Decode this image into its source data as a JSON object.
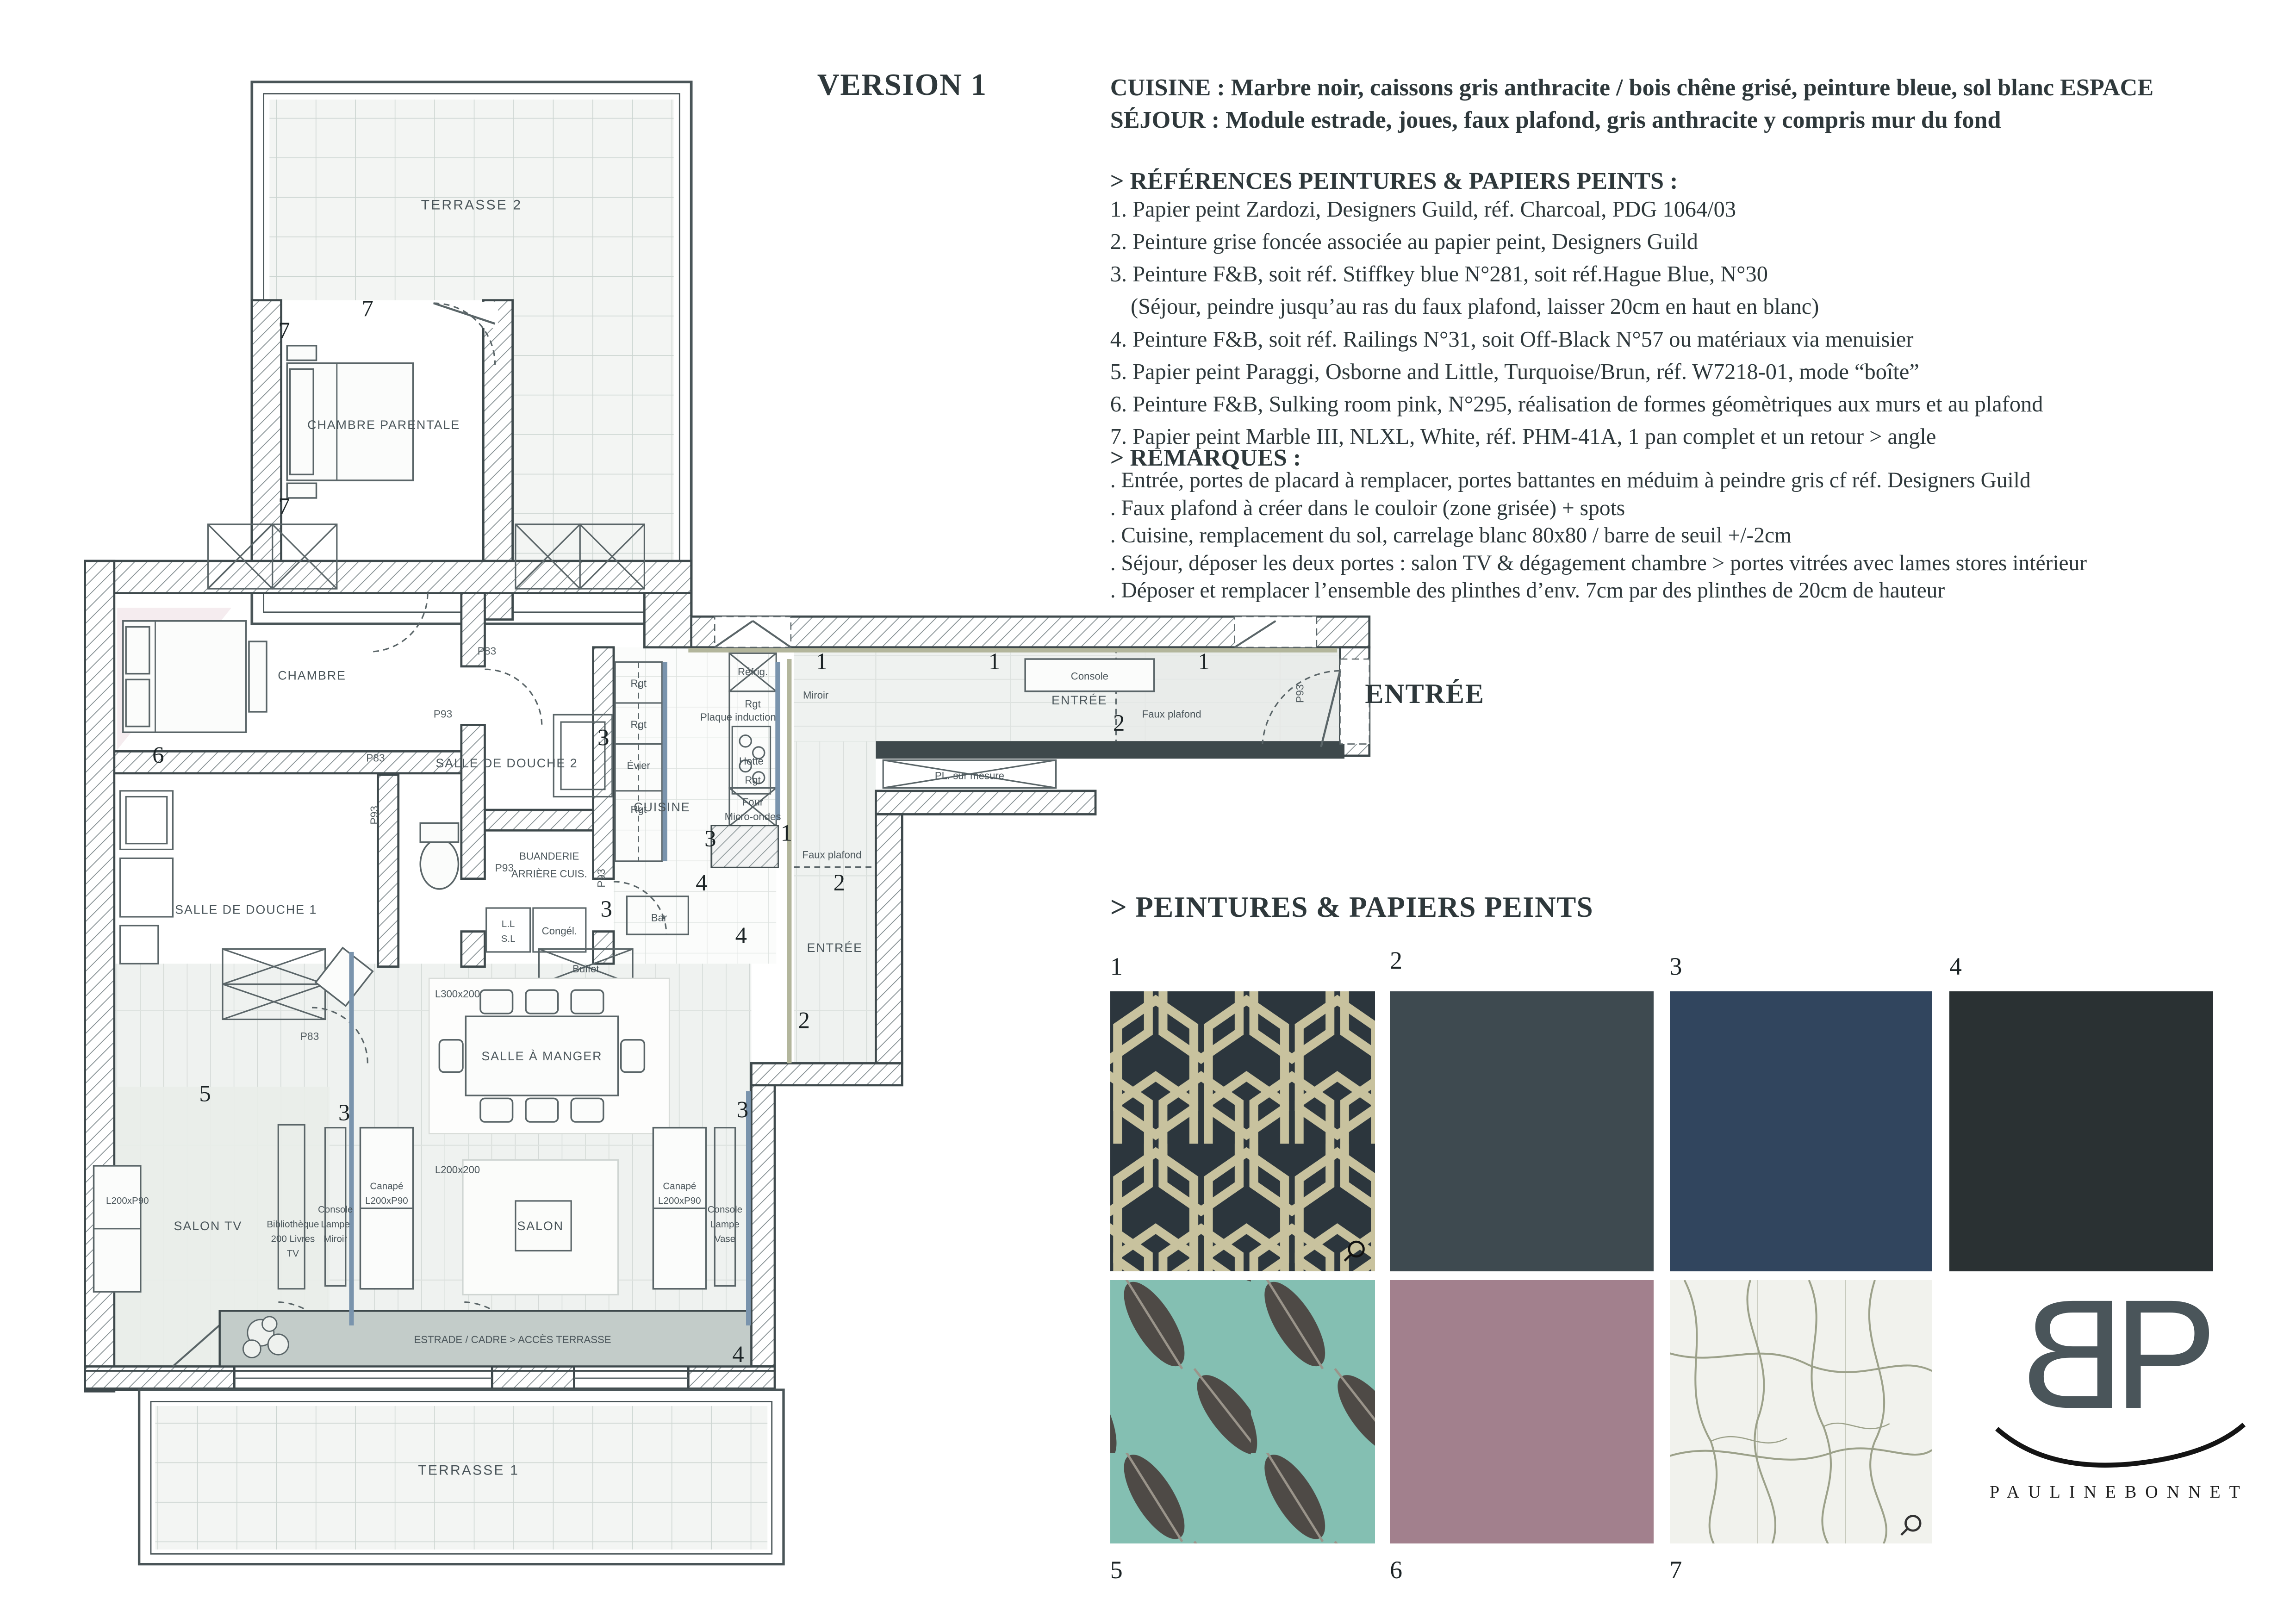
{
  "title": "VERSION 1",
  "header": {
    "line1": "CUISINE : Marbre noir, caissons gris anthracite / bois chêne grisé, peinture bleue, sol blanc  ESPACE",
    "line2": "SÉJOUR : Module estrade, joues, faux plafond, gris anthracite y compris mur du fond"
  },
  "references": {
    "title": "> RÉFÉRENCES PEINTURES & PAPIERS PEINTS :",
    "items": [
      "1. Papier peint Zardozi, Designers Guild, réf. Charcoal, PDG 1064/03",
      "2. Peinture grise foncée associée au papier peint, Designers Guild",
      "3. Peinture F&B, soit réf. Stiffkey blue N°281, soit réf.Hague Blue, N°30",
      "(Séjour, peindre jusqu’au ras du faux plafond, laisser 20cm en haut en blanc)",
      "4. Peinture F&B, soit réf. Railings N°31, soit Off-Black N°57 ou matériaux via menuisier",
      "5. Papier peint Paraggi, Osborne and Little, Turquoise/Brun, réf. W7218-01, mode “boîte”",
      "6. Peinture F&B, Sulking room pink, N°295, réalisation de formes géomètriques aux murs et au plafond",
      "7. Papier peint Marble III, NLXL, White, réf. PHM-41A, 1 pan complet et un retour > angle"
    ]
  },
  "remarques": {
    "title": "> REMARQUES :",
    "items": [
      ". Entrée, portes de placard à remplacer, portes battantes en méduim à peindre gris cf réf. Designers Guild",
      ". Faux plafond à créer dans le couloir (zone grisée) + spots",
      ". Cuisine, remplacement du sol, carrelage blanc 80x80 / barre de seuil +/-2cm",
      ". Séjour, déposer les deux portes : salon TV & dégagement chambre > portes vitrées avec lames stores intérieur",
      ". Déposer et remplacer l’ensemble des plinthes d’env. 7cm par des plinthes de 20cm de hauteur"
    ]
  },
  "entree_label": "ENTRÉE",
  "swatches": {
    "title": "> PEINTURES & PAPIERS PEINTS",
    "items": [
      {
        "num": "1",
        "type": "wallpaper-zardozi",
        "bg": "#2c363d",
        "line": "#c8c29e"
      },
      {
        "num": "2",
        "type": "solid",
        "color": "#3e4a50"
      },
      {
        "num": "3",
        "type": "solid",
        "color": "#31455e"
      },
      {
        "num": "4",
        "type": "solid",
        "color": "#2a3133"
      },
      {
        "num": "5",
        "type": "wallpaper-paraggi",
        "bg": "#84bfb2",
        "feather": "#4e4a46"
      },
      {
        "num": "6",
        "type": "solid",
        "color": "#a2808d"
      },
      {
        "num": "7",
        "type": "wallpaper-marble",
        "bg": "#f1f2ed",
        "vein": "#8e9479"
      }
    ]
  },
  "logo": {
    "letter_b": "B",
    "letter_p": "P",
    "name": "PAULINEBONNET"
  },
  "colors": {
    "ink": "#2e383b",
    "wall": "#3e494c",
    "accent_blue": "#7a94ad",
    "sage": "#b3b69c",
    "estrade_gray": "#c3ccc9",
    "tint_gray": "#e9ede9",
    "tint_pink": "#f3e9ec"
  },
  "floorplan": {
    "labels": {
      "terrasse2": "TERRASSE 2",
      "terrasse1": "TERRASSE 1",
      "chambre_parentale": "CHAMBRE PARENTALE",
      "chambre": "CHAMBRE",
      "salle_de_douche_1": "SALLE DE DOUCHE 1",
      "salle_de_douche_2": "SALLE DE DOUCHE 2",
      "buanderie": "BUANDERIE",
      "arriere_cuis": "ARRIÈRE CUIS.",
      "cuisine": "CUISINE",
      "entree": "ENTRÉE",
      "salle_a_manger": "SALLE À MANGER",
      "salon": "SALON",
      "salon_tv": "SALON TV",
      "estrade": "ESTRADE / CADRE > ACCÈS TERRASSE",
      "console": "Console",
      "lampe": "Lampe",
      "miroir": "Miroir",
      "vase": "Vase",
      "faux_plafond": "Faux plafond",
      "pl_sur_mesure": "PL. sur mesure",
      "refrig": "Réfrig.",
      "rgt": "Rgt",
      "evier": "Évier",
      "plaque_induction": "Plaque induction",
      "hotte": "Hotte",
      "four": "Four",
      "micro_ondes": "Micro-ondes",
      "congel": "Congél.",
      "ll": "L.L",
      "sl": "S.L",
      "bar": "Bar",
      "buffet": "Buffet",
      "canape": "Canapé",
      "l200xp90": "L200xP90",
      "l200x200": "L200x200",
      "l300x200": "L300x200",
      "bibliotheque": "Bibliothèque",
      "livres200": "200 Livres",
      "tv": "TV",
      "p83": "P83",
      "p93": "P93",
      "n1": "1",
      "n2": "2",
      "n3": "3",
      "n4": "4",
      "n5": "5",
      "n6": "6",
      "n7": "7"
    }
  }
}
